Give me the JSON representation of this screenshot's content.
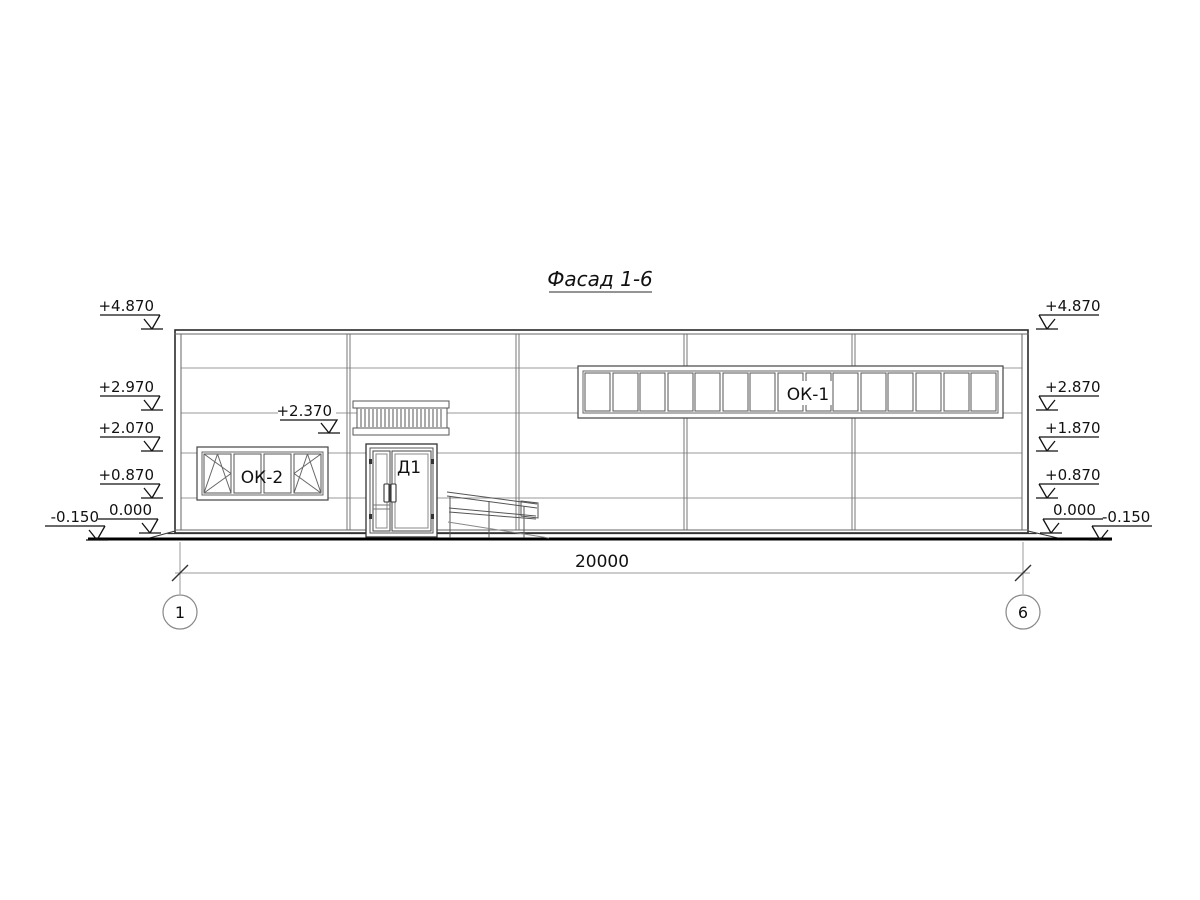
{
  "drawing_title": "Фасад 1-6",
  "labels": {
    "strip_window": "ОК-1",
    "left_window": "ОК-2",
    "door": "Д1",
    "canopy_elevation": "+2.370"
  },
  "elevations_left": [
    "+4.870",
    "+2.970",
    "+2.070",
    "+0.870",
    "0.000",
    "-0.150"
  ],
  "elevations_right": [
    "+4.870",
    "+2.870",
    "+1.870",
    "+0.870",
    "0.000",
    "-0.150"
  ],
  "dimension": {
    "total_width": "20000"
  },
  "axes": {
    "left": "1",
    "right": "6"
  }
}
